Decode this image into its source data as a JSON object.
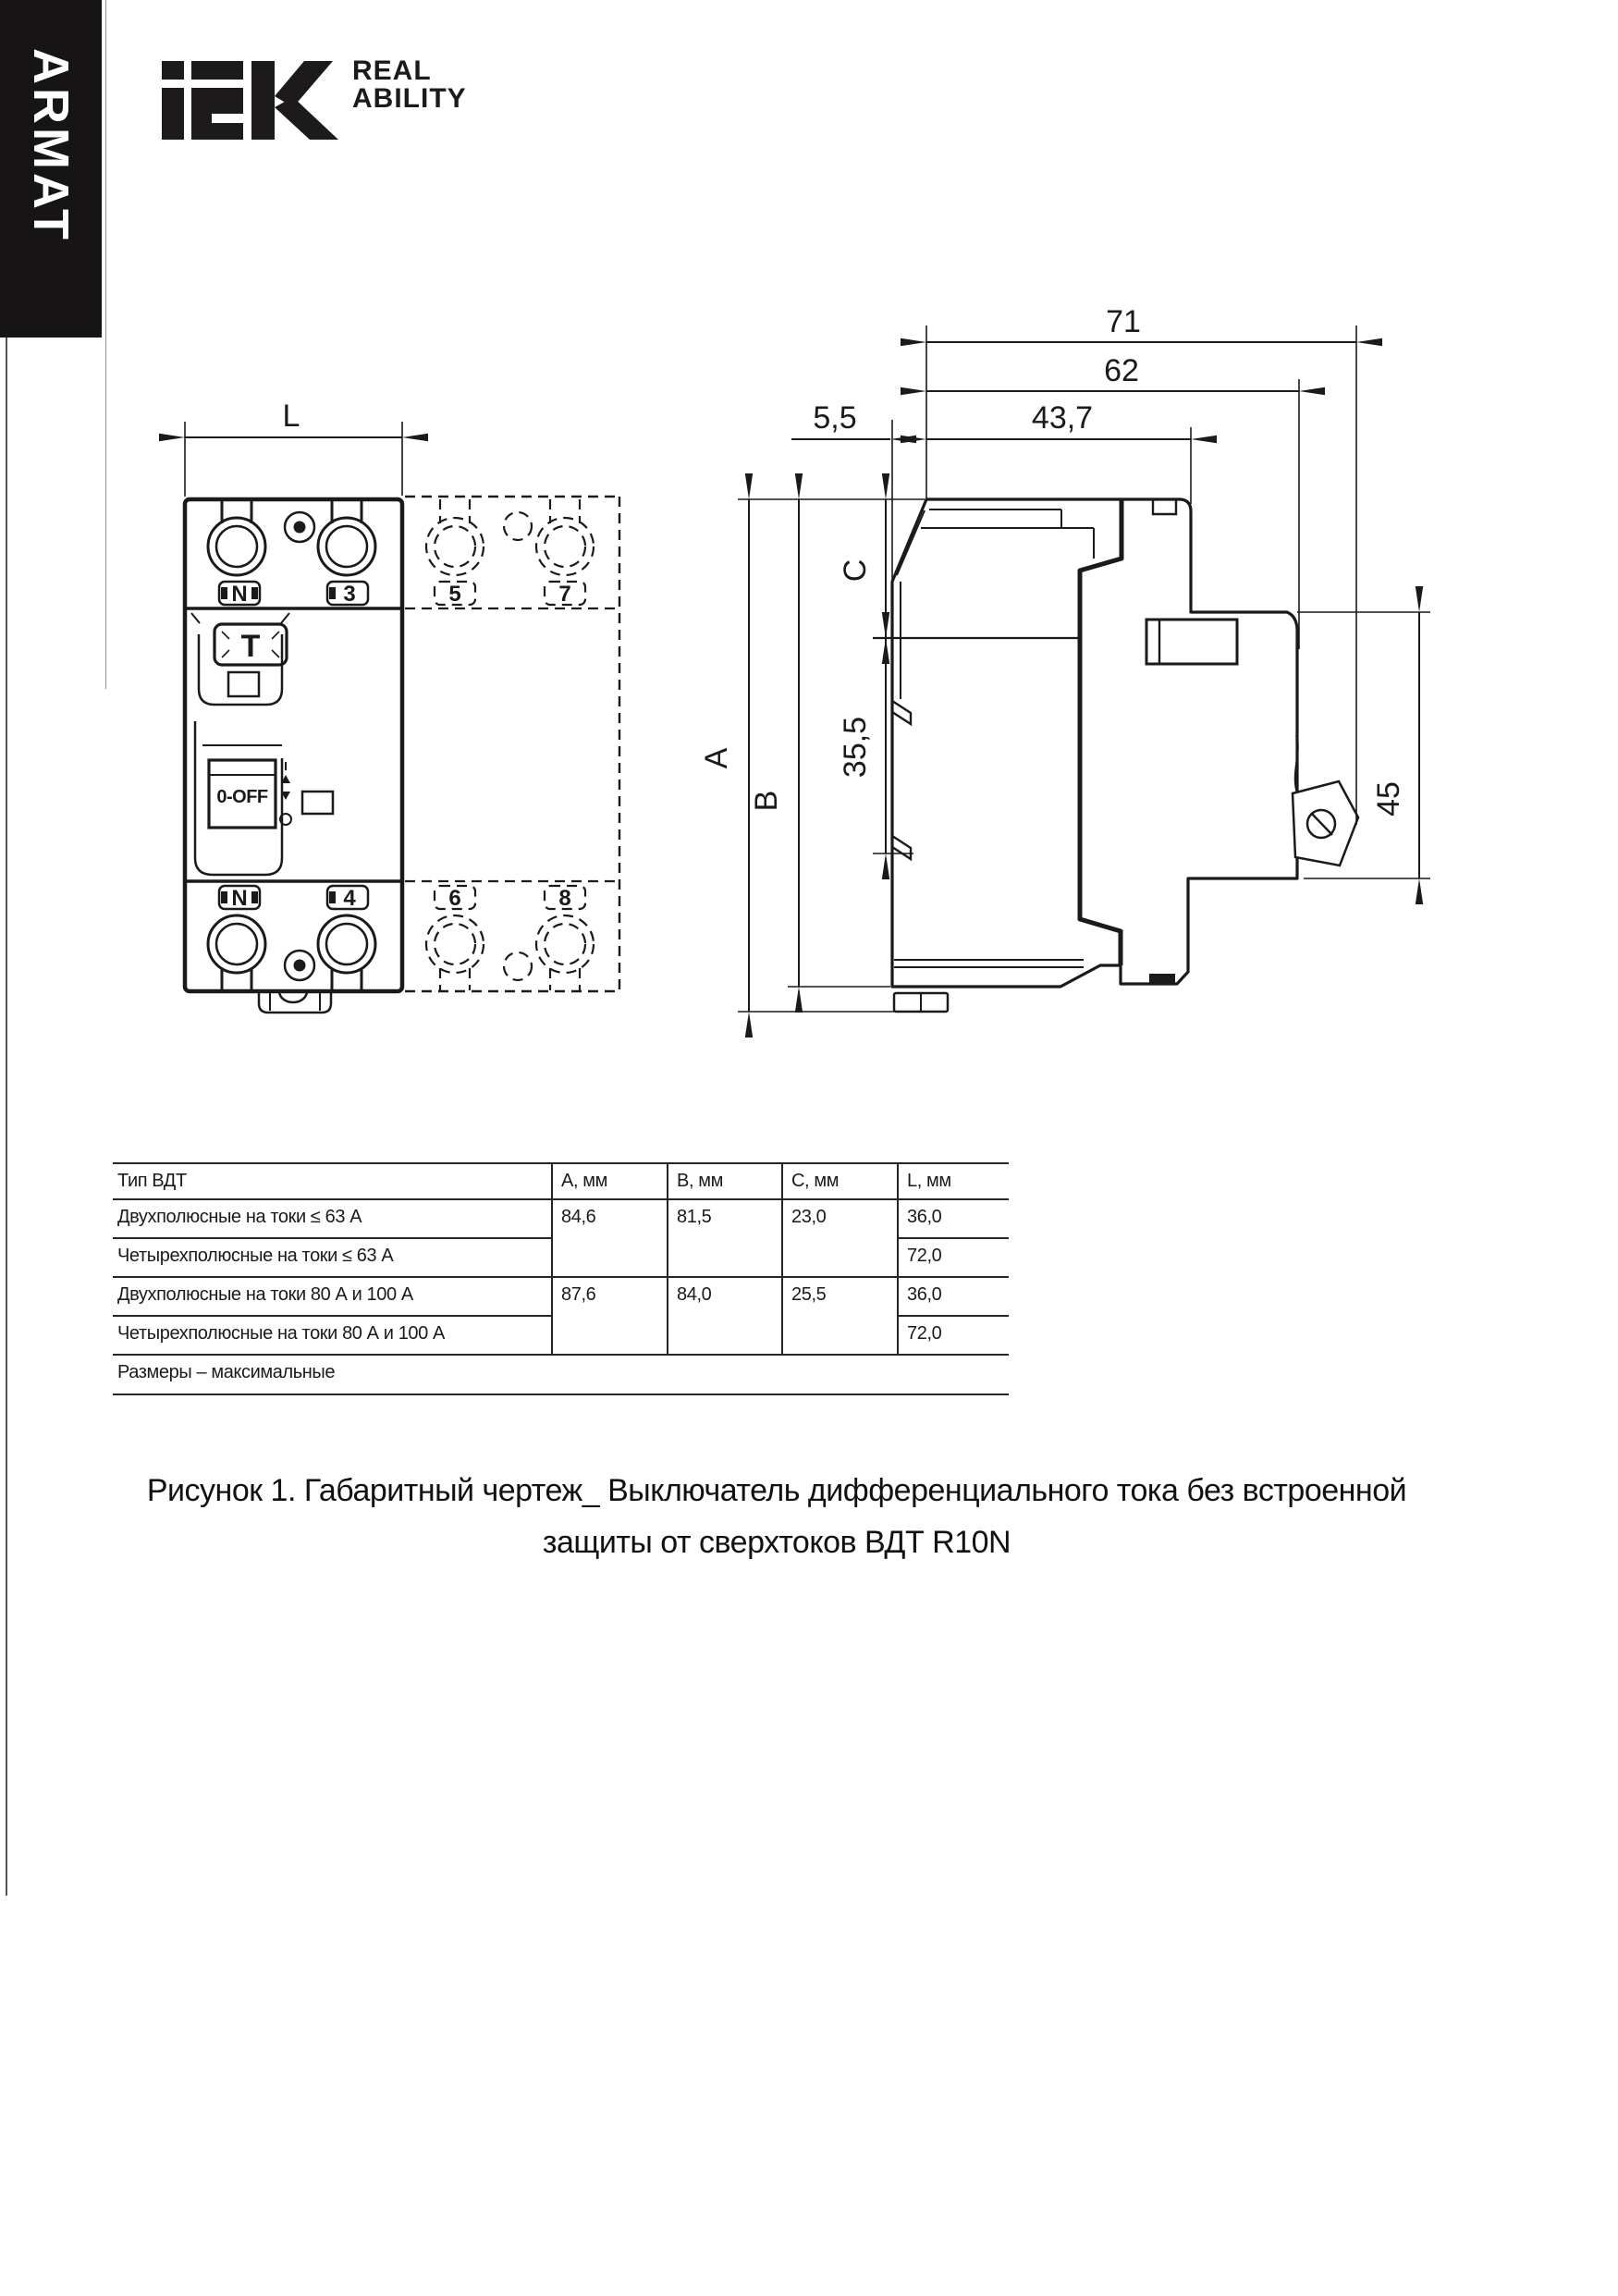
{
  "banner": {
    "text": "ARMAT"
  },
  "logo": {
    "brand": "iek",
    "tagline_line1": "REAL",
    "tagline_line2": "ABILITY"
  },
  "front_view": {
    "dim_width": "L",
    "terminal_labels": {
      "top_left": "N",
      "top_right": "3",
      "bottom_left": "N",
      "bottom_right": "4"
    },
    "pole4_labels": {
      "top_left": "5",
      "top_right": "7",
      "bottom_left": "6",
      "bottom_right": "8"
    },
    "test_button": "T",
    "switch": "0-OFF"
  },
  "side_view": {
    "dim_total_depth": "71",
    "dim_rail_depth": "62",
    "dim_front_offset": "5,5",
    "dim_body_depth": "43,7",
    "dim_height_a": "A",
    "dim_height_b": "B",
    "dim_height_c": "C",
    "dim_din_height": "35,5",
    "dim_terminal_zone": "45"
  },
  "table": {
    "headers": [
      "Тип ВДТ",
      "А, мм",
      "В, мм",
      "С, мм",
      "L, мм"
    ],
    "rows": [
      {
        "type": "Двухполюсные на токи ≤ 63 А",
        "a": "84,6",
        "b": "81,5",
        "c": "23,0",
        "l": "36,0"
      },
      {
        "type": "Четырехполюсные на токи ≤ 63 А",
        "l": "72,0"
      },
      {
        "type": "Двухполюсные на токи 80 А и 100 А",
        "a": "87,6",
        "b": "84,0",
        "c": "25,5",
        "l": "36,0"
      },
      {
        "type": "Четырехполюсные на токи 80 А и 100 А",
        "l": "72,0"
      }
    ],
    "footnote": "Размеры – максимальные"
  },
  "caption": {
    "line1": "Рисунок 1. Габаритный чертеж_ Выключатель дифференциального тока без встроенной",
    "line2": "защиты от сверхтоков ВДТ R10N"
  }
}
